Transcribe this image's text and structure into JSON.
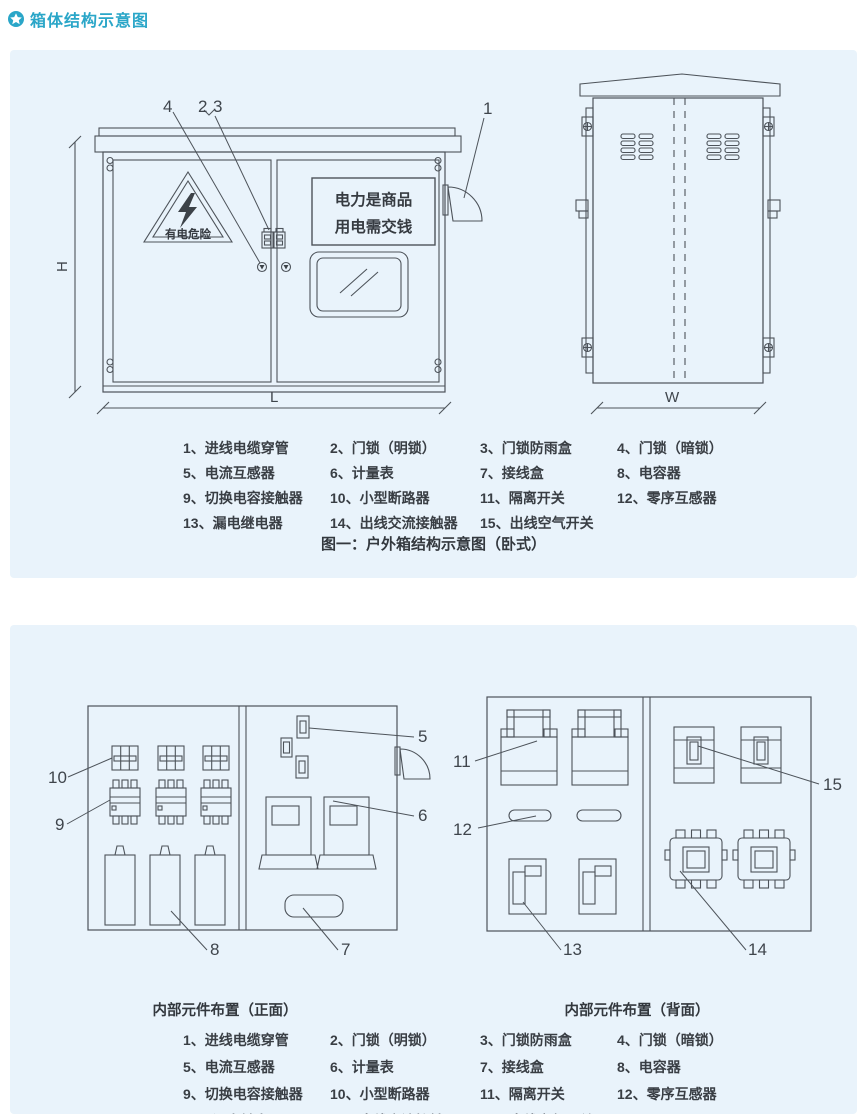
{
  "page": {
    "title": "箱体结构示意图"
  },
  "colors": {
    "accent": "#2aa6c8",
    "panel_bg": "#e9f3fb",
    "line": "#4d535a"
  },
  "figure1": {
    "caption": "图一：户外箱结构示意图（卧式）",
    "warning_text": "有电危险",
    "sign_line1": "电力是商品",
    "sign_line2": "用电需交钱",
    "dims": {
      "h": "H",
      "l": "L",
      "w": "W"
    },
    "callouts": {
      "c1": "1",
      "c2": "2",
      "c3": "3",
      "c4": "4"
    }
  },
  "figure2": {
    "caption_front": "内部元件布置（正面）",
    "caption_back": "内部元件布置（背面）",
    "callouts": {
      "c5": "5",
      "c6": "6",
      "c7": "7",
      "c8": "8",
      "c9": "9",
      "c10": "10",
      "c11": "11",
      "c12": "12",
      "c13": "13",
      "c14": "14",
      "c15": "15"
    }
  },
  "legend": {
    "items": [
      "1、进线电缆穿管",
      "2、门锁（明锁）",
      "3、门锁防雨盒",
      "4、门锁（暗锁）",
      "5、电流互感器",
      "6、计量表",
      "7、接线盒",
      "8、电容器",
      "9、切换电容接触器",
      "10、小型断路器",
      "11、隔离开关",
      "12、零序互感器",
      "13、漏电继电器",
      "14、出线交流接触器",
      "15、出线空气开关"
    ]
  }
}
